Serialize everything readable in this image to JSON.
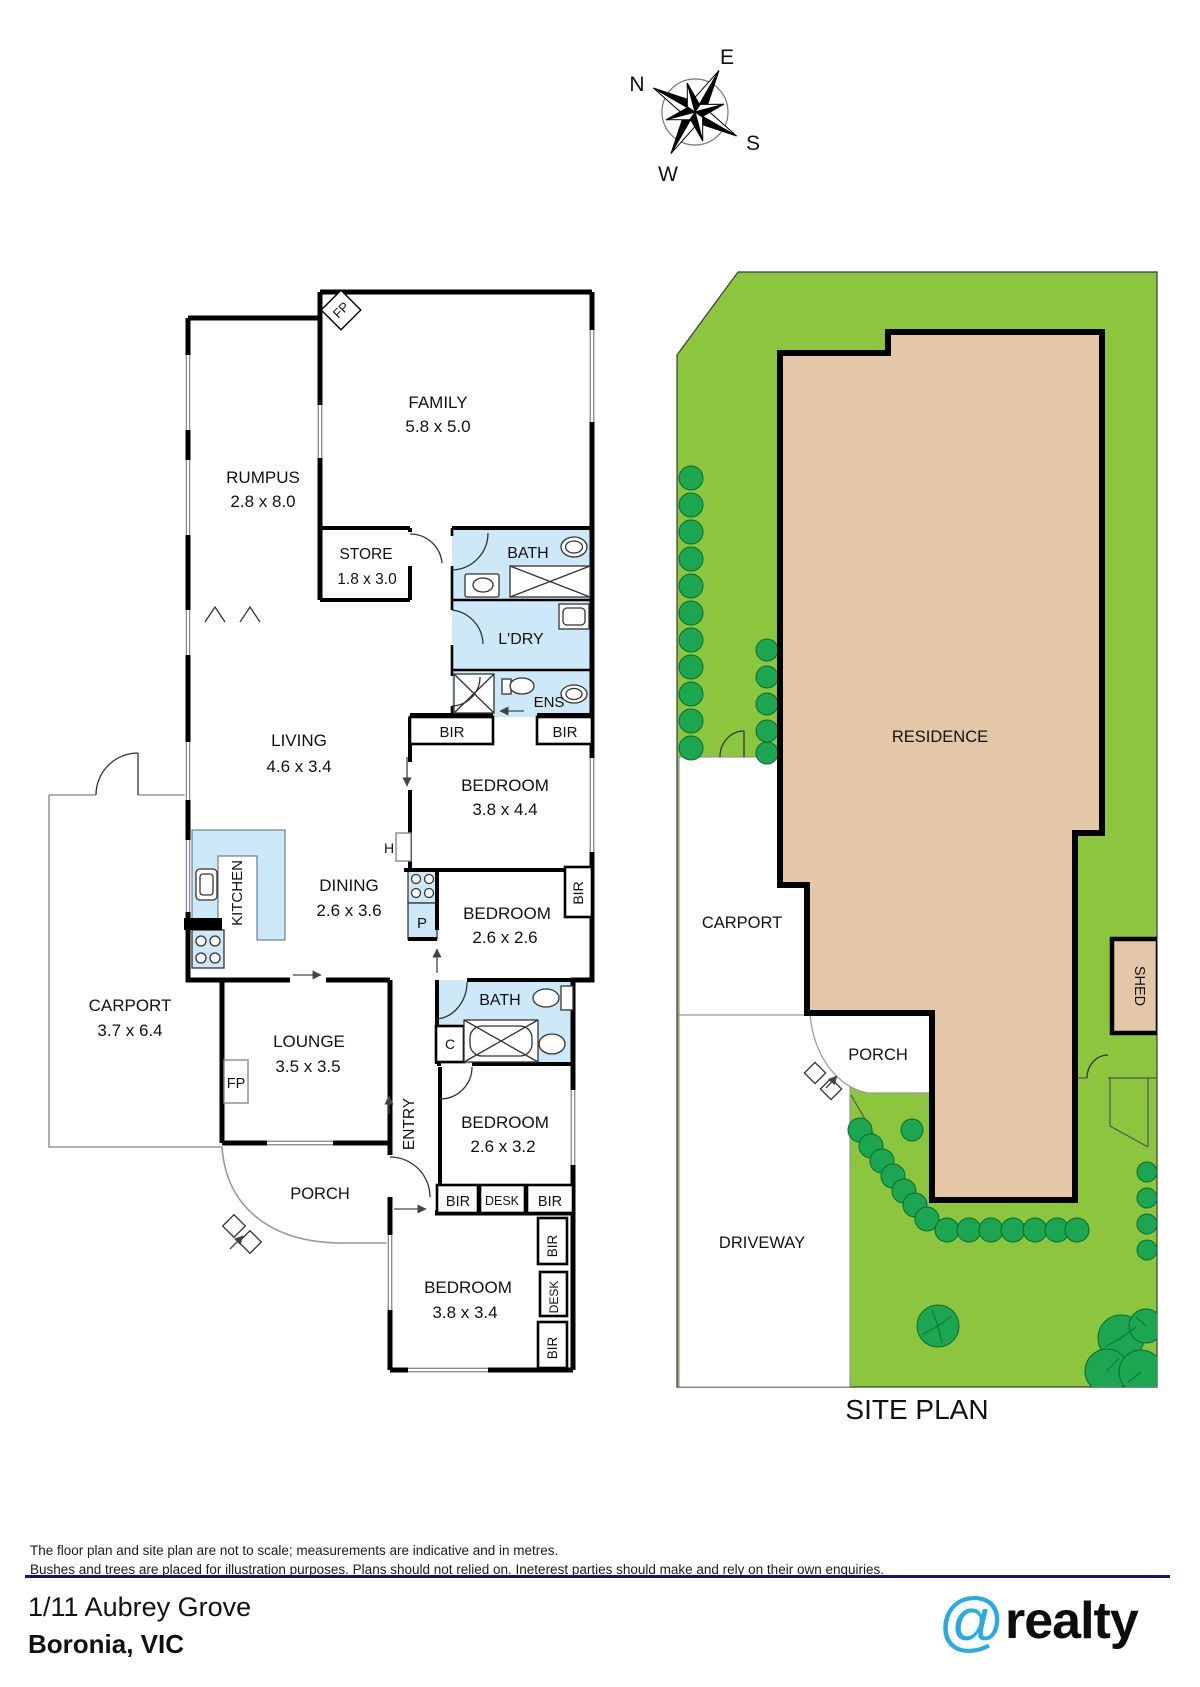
{
  "compass": {
    "n": "N",
    "e": "E",
    "s": "S",
    "w": "W"
  },
  "floor_plan": {
    "family": "FAMILY",
    "family_dims": "5.8 x 5.0",
    "rumpus": "RUMPUS",
    "rumpus_dims": "2.8 x 8.0",
    "store": "STORE",
    "store_dims": "1.8 x 3.0",
    "bath": "BATH",
    "laundry": "L'DRY",
    "ensuite": "ENS",
    "bir": "BIR",
    "desk": "DESK",
    "bedroom": "BEDROOM",
    "bedroom1_dims": "3.8 x 4.4",
    "bedroom2_dims": "2.6 x 2.6",
    "bedroom3_dims": "2.6 x 3.2",
    "bedroom4_dims": "3.8 x 3.4",
    "living": "LIVING",
    "living_dims": "4.6 x 3.4",
    "kitchen": "KITCHEN",
    "dining": "DINING",
    "dining_dims": "2.6 x 3.6",
    "carport": "CARPORT",
    "carport_dims": "3.7 x 6.4",
    "lounge": "LOUNGE",
    "lounge_dims": "3.5 x 3.5",
    "porch": "PORCH",
    "entry": "ENTRY",
    "fireplace": "FP",
    "hot_water": "H",
    "pantry": "P",
    "cupboard": "C"
  },
  "site_plan": {
    "residence": "RESIDENCE",
    "carport": "CARPORT",
    "porch": "PORCH",
    "shed": "SHED",
    "driveway": "DRIVEWAY",
    "title": "SITE PLAN"
  },
  "footer": {
    "disclaimer_line1": "The floor plan and site plan are not to scale; measurements are indicative and in metres.",
    "disclaimer_line2": "Bushes and trees are placed for illustration purposes. Plans should not relied on. Ineterest parties should make and rely on their own enquiries.",
    "address_line1": "1/11 Aubrey Grove",
    "address_line2": "Boronia, VIC",
    "logo_at": "@",
    "logo_name": "realty"
  },
  "colors": {
    "wet_area": "#CDE8F7",
    "lawn": "#8CC63E",
    "tree": "#1CA651",
    "residence_fill": "#E4C7A7",
    "divider_navy": "#1B1464",
    "logo_blue": "#29ABE2"
  }
}
